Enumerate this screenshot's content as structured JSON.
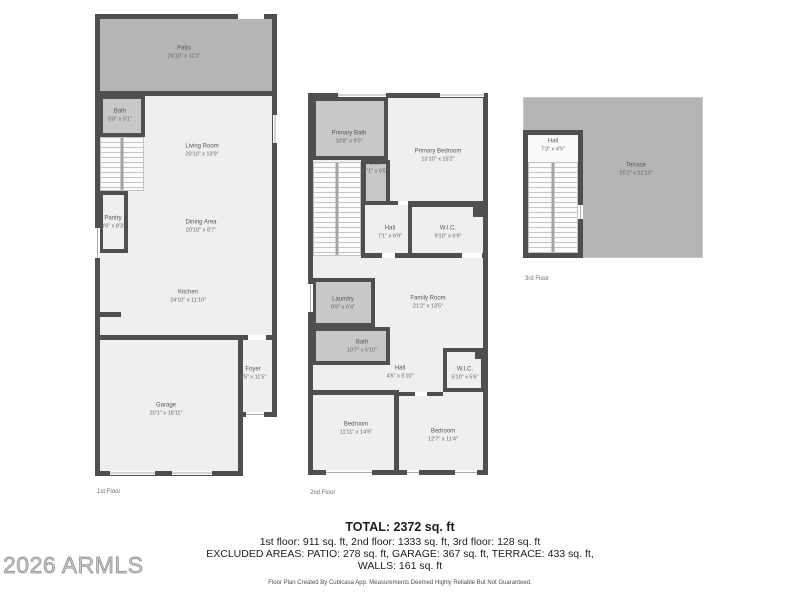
{
  "watermark": {
    "text": "2026 ARMLS"
  },
  "floors": [
    {
      "label": "1st Floor",
      "rooms": [
        {
          "name": "Patio",
          "dims": "24'10\" x 11'2\""
        },
        {
          "name": "Bath",
          "dims": "5'8\" x 5'1\""
        },
        {
          "name": "Living Room",
          "dims": "20'10\" x 13'9\""
        },
        {
          "name": "Pantry",
          "dims": "3'6\" x 8'3\""
        },
        {
          "name": "Dining Area",
          "dims": "20'10\" x 8'7\""
        },
        {
          "name": "Kitchen",
          "dims": "24'10\" x 11'10\""
        },
        {
          "name": "Garage",
          "dims": "20'1\" x 18'11\""
        },
        {
          "name": "Foyer",
          "dims": "5'5\" x 11'5\""
        }
      ]
    },
    {
      "label": "2nd Floor",
      "rooms": [
        {
          "name": "Primary Bath",
          "dims": "10'8\" x 9'0\""
        },
        {
          "name": "Bath",
          "dims": "7'1\" x 6'5\""
        },
        {
          "name": "Primary Bedroom",
          "dims": "13'10\" x 15'2\""
        },
        {
          "name": "Hall",
          "dims": "7'1\" x 6'9\""
        },
        {
          "name": "W.I.C.",
          "dims": "9'10\" x 6'9\""
        },
        {
          "name": "Laundry",
          "dims": "8'6\" x 6'4\""
        },
        {
          "name": "Family Room",
          "dims": "21'2\" x 13'5\""
        },
        {
          "name": "Bath",
          "dims": "10'7\" x 5'10\""
        },
        {
          "name": "Hall",
          "dims": "4'6\" x 5'10\""
        },
        {
          "name": "W.I.C.",
          "dims": "5'10\" x 5'6\""
        },
        {
          "name": "Bedroom",
          "dims": "11'11\" x 14'9\""
        },
        {
          "name": "Bedroom",
          "dims": "12'7\" x 11'4\""
        }
      ]
    },
    {
      "label": "3rd Floor",
      "rooms": [
        {
          "name": "Hall",
          "dims": "7'3\" x 4'5\""
        },
        {
          "name": "Terrace",
          "dims": "25'2\" x 22'10\""
        }
      ]
    }
  ],
  "summary": {
    "total": "TOTAL: 2372 sq. ft",
    "by_floor": "1st floor: 911 sq. ft, 2nd floor: 1333 sq. ft, 3rd floor: 128 sq. ft",
    "excluded": "EXCLUDED AREAS: PATIO: 278 sq. ft, GARAGE: 367 sq. ft, TERRACE: 433 sq. ft,",
    "walls": "WALLS: 161 sq. ft"
  },
  "footer": {
    "note": "Floor Plan Created By Cubicasa App. Measurements Deemed Highly Reliable But Not Guaranteed."
  },
  "colors": {
    "wall": "#4f4f4f",
    "outdoor": "#b5b5b5",
    "wet_room": "#c8c8c8",
    "floor": "#f0efee",
    "background": "#ffffff"
  }
}
